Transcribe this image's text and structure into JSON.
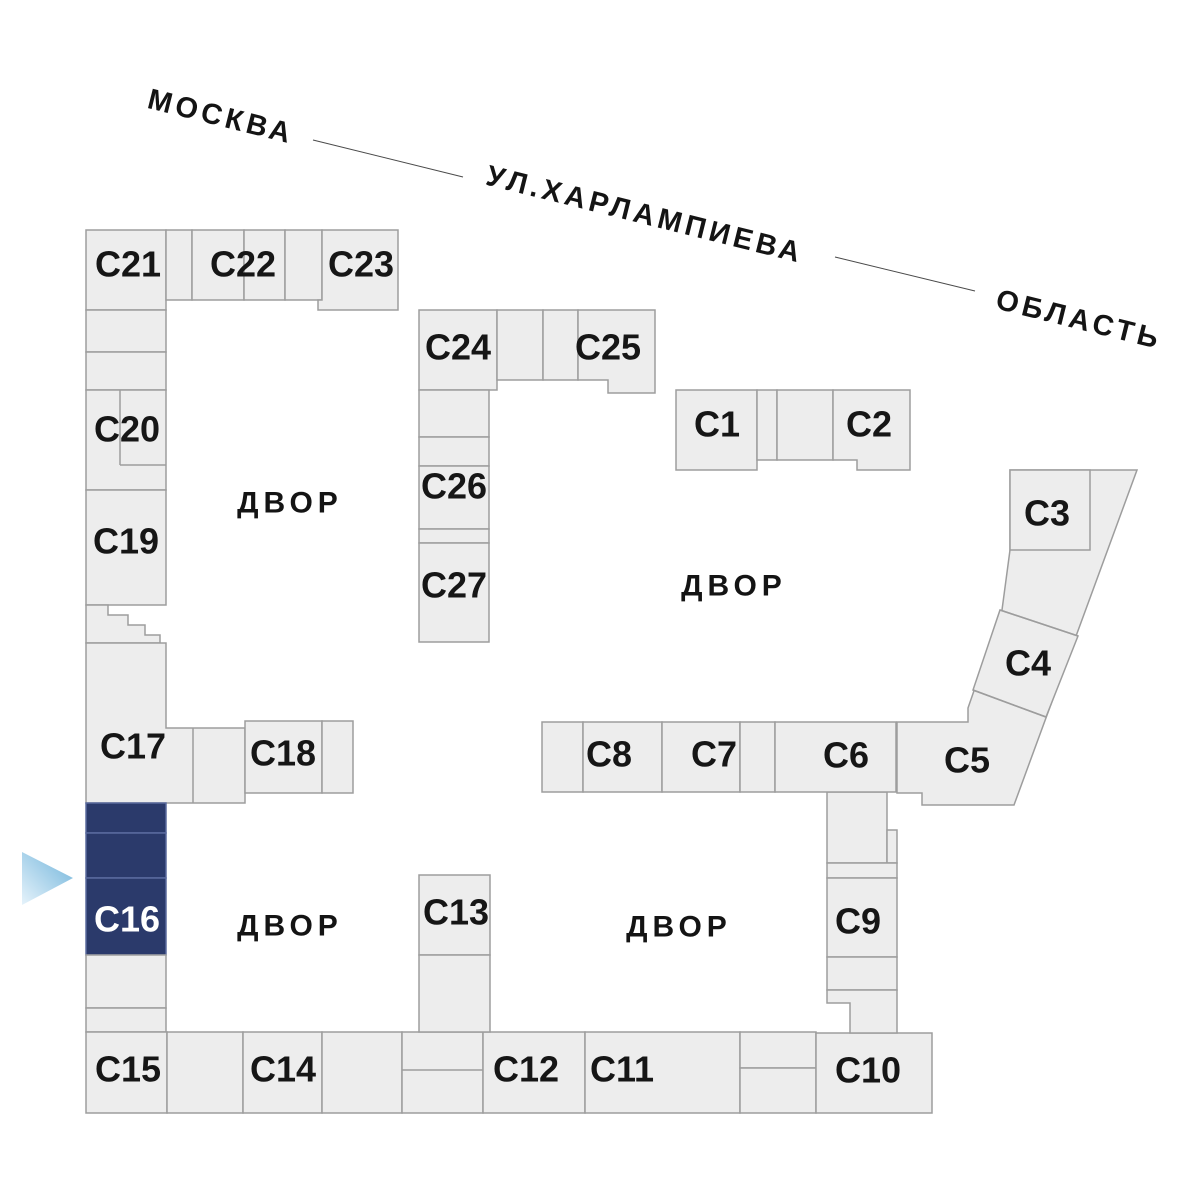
{
  "street": {
    "name": "УЛ.ХАРЛАМПИЕВА",
    "direction_left": "МОСКВА",
    "direction_right": "ОБЛАСТЬ"
  },
  "courtyard_label": "ДВОР",
  "selected_section": "С16",
  "colors": {
    "building_fill": "#ededed",
    "building_stroke": "#9d9d9d",
    "highlight_fill": "#2b3a6b",
    "highlight_stroke": "#5b6b9e",
    "arrow_light": "#e6f3fb",
    "arrow_dark": "#6fb3da",
    "text": "#161616",
    "highlight_text": "#ffffff"
  },
  "courtyards": [
    {
      "x": 290,
      "y": 503
    },
    {
      "x": 734,
      "y": 586
    },
    {
      "x": 290,
      "y": 926
    },
    {
      "x": 679,
      "y": 927
    }
  ],
  "sections": [
    {
      "label": "С21",
      "rect": [
        86,
        230,
        80,
        80
      ],
      "lx": 128,
      "ly": 264
    },
    {
      "rect": [
        166,
        230,
        26,
        70
      ]
    },
    {
      "rect": [
        192,
        230,
        52,
        70
      ]
    },
    {
      "label": "С22",
      "rect": [
        244,
        230,
        41,
        70
      ],
      "lx": 243,
      "ly": 264
    },
    {
      "rect": [
        285,
        230,
        37,
        70
      ]
    },
    {
      "label": "С23",
      "poly": "322,230 398,230 398,310 318,310 318,300 322,300",
      "lx": 361,
      "ly": 264
    },
    {
      "rect": [
        86,
        310,
        80,
        42
      ]
    },
    {
      "rect": [
        86,
        352,
        80,
        38
      ]
    },
    {
      "label": "С20",
      "rect": [
        86,
        390,
        80,
        100
      ],
      "lx": 127,
      "ly": 429
    },
    {
      "label": "С19",
      "rect": [
        86,
        490,
        80,
        115
      ],
      "lx": 126,
      "ly": 541
    },
    {
      "poly": "86,605 108,605 108,615 128,615 128,625 145,625 145,635 160,635 160,643 86,643"
    },
    {
      "label": "С17",
      "poly": "86,643 166,643 166,728 245,728 245,803 86,803",
      "lx": 133,
      "ly": 746
    },
    {
      "label": "С18",
      "rect": [
        245,
        721,
        77,
        72
      ],
      "lx": 283,
      "ly": 753
    },
    {
      "rect": [
        322,
        721,
        31,
        72
      ]
    },
    {
      "rect": [
        86,
        803,
        80,
        30
      ],
      "hl": true
    },
    {
      "rect": [
        86,
        833,
        80,
        45
      ],
      "hl": true
    },
    {
      "label": "С16",
      "rect": [
        86,
        878,
        80,
        77
      ],
      "hl": true,
      "lx": 127,
      "ly": 919
    },
    {
      "rect": [
        86,
        955,
        80,
        53
      ]
    },
    {
      "rect": [
        86,
        1008,
        80,
        24
      ]
    },
    {
      "label": "С15",
      "rect": [
        86,
        1032,
        81,
        81
      ],
      "lx": 128,
      "ly": 1069
    },
    {
      "rect": [
        167,
        1032,
        76,
        81
      ]
    },
    {
      "label": "С14",
      "rect": [
        243,
        1032,
        79,
        81
      ],
      "lx": 283,
      "ly": 1069
    },
    {
      "rect": [
        322,
        1032,
        80,
        81
      ]
    },
    {
      "rect": [
        402,
        1032,
        81,
        81
      ]
    },
    {
      "label": "С12",
      "rect": [
        483,
        1032,
        102,
        81
      ],
      "lx": 526,
      "ly": 1069
    },
    {
      "label": "С11",
      "rect": [
        585,
        1032,
        155,
        81
      ],
      "lx": 622,
      "ly": 1069
    },
    {
      "rect": [
        740,
        1032,
        76,
        36
      ]
    },
    {
      "rect": [
        740,
        1068,
        76,
        45
      ]
    },
    {
      "label": "С10",
      "rect": [
        816,
        1033,
        116,
        80
      ],
      "lx": 868,
      "ly": 1070
    },
    {
      "label": "С13",
      "rect": [
        419,
        875,
        71,
        80
      ],
      "lx": 456,
      "ly": 912
    },
    {
      "rect": [
        419,
        955,
        71,
        77
      ]
    },
    {
      "rect": [
        827,
        792,
        60,
        71
      ]
    },
    {
      "rect": [
        887,
        830,
        10,
        33
      ]
    },
    {
      "rect": [
        827,
        863,
        70,
        15
      ]
    },
    {
      "label": "С9",
      "rect": [
        827,
        878,
        70,
        79
      ],
      "lx": 858,
      "ly": 921
    },
    {
      "rect": [
        827,
        957,
        70,
        33
      ]
    },
    {
      "poly": "827,990 897,990 897,1033 850,1033 850,1003 827,1003"
    },
    {
      "rect": [
        542,
        722,
        41,
        70
      ]
    },
    {
      "label": "С8",
      "rect": [
        583,
        722,
        79,
        70
      ],
      "lx": 609,
      "ly": 754
    },
    {
      "label": "С7",
      "rect": [
        662,
        722,
        78,
        70
      ],
      "lx": 714,
      "ly": 754
    },
    {
      "rect": [
        740,
        722,
        35,
        70
      ]
    },
    {
      "label": "С6",
      "rect": [
        775,
        722,
        121,
        70
      ],
      "lx": 846,
      "ly": 755
    },
    {
      "poly": "1010,470 1137,470 1014,805 922,805 922,793 897,793 897,722 968,722 968,708 1002,610 1010,550"
    },
    {
      "label": "С3",
      "rect": [
        1010,
        470,
        80,
        80
      ],
      "lx": 1047,
      "ly": 513
    },
    {
      "label": "С4",
      "poly": "1000,610 1078,636 1046,717 973,690",
      "lx": 1028,
      "ly": 663
    },
    {
      "label": "С5",
      "lx": 967,
      "ly": 760
    },
    {
      "label": "С24",
      "rect": [
        419,
        310,
        78,
        80
      ],
      "lx": 458,
      "ly": 347
    },
    {
      "rect": [
        497,
        310,
        46,
        70
      ]
    },
    {
      "rect": [
        543,
        310,
        35,
        70
      ]
    },
    {
      "label": "С25",
      "poly": "578,310 655,310 655,393 608,393 608,380 578,380",
      "lx": 608,
      "ly": 347
    },
    {
      "rect": [
        419,
        390,
        70,
        47
      ]
    },
    {
      "rect": [
        419,
        437,
        70,
        29
      ]
    },
    {
      "label": "С26",
      "rect": [
        419,
        466,
        70,
        63
      ],
      "lx": 454,
      "ly": 486
    },
    {
      "rect": [
        419,
        529,
        70,
        14
      ]
    },
    {
      "label": "С27",
      "rect": [
        419,
        543,
        70,
        99
      ],
      "lx": 454,
      "ly": 585
    },
    {
      "label": "С1",
      "rect": [
        676,
        390,
        81,
        80
      ],
      "lx": 717,
      "ly": 424
    },
    {
      "rect": [
        757,
        390,
        20,
        70
      ]
    },
    {
      "rect": [
        777,
        390,
        56,
        70
      ]
    },
    {
      "label": "С2",
      "poly": "833,390 910,390 910,470 857,470 857,460 833,460",
      "lx": 869,
      "ly": 424
    }
  ],
  "detail_lines": [
    [
      120,
      390,
      120,
      465
    ],
    [
      120,
      465,
      166,
      465
    ],
    [
      193,
      728,
      193,
      803
    ],
    [
      402,
      1070,
      483,
      1070
    ],
    [
      1000,
      610,
      1078,
      636
    ],
    [
      973,
      690,
      1046,
      717
    ]
  ]
}
